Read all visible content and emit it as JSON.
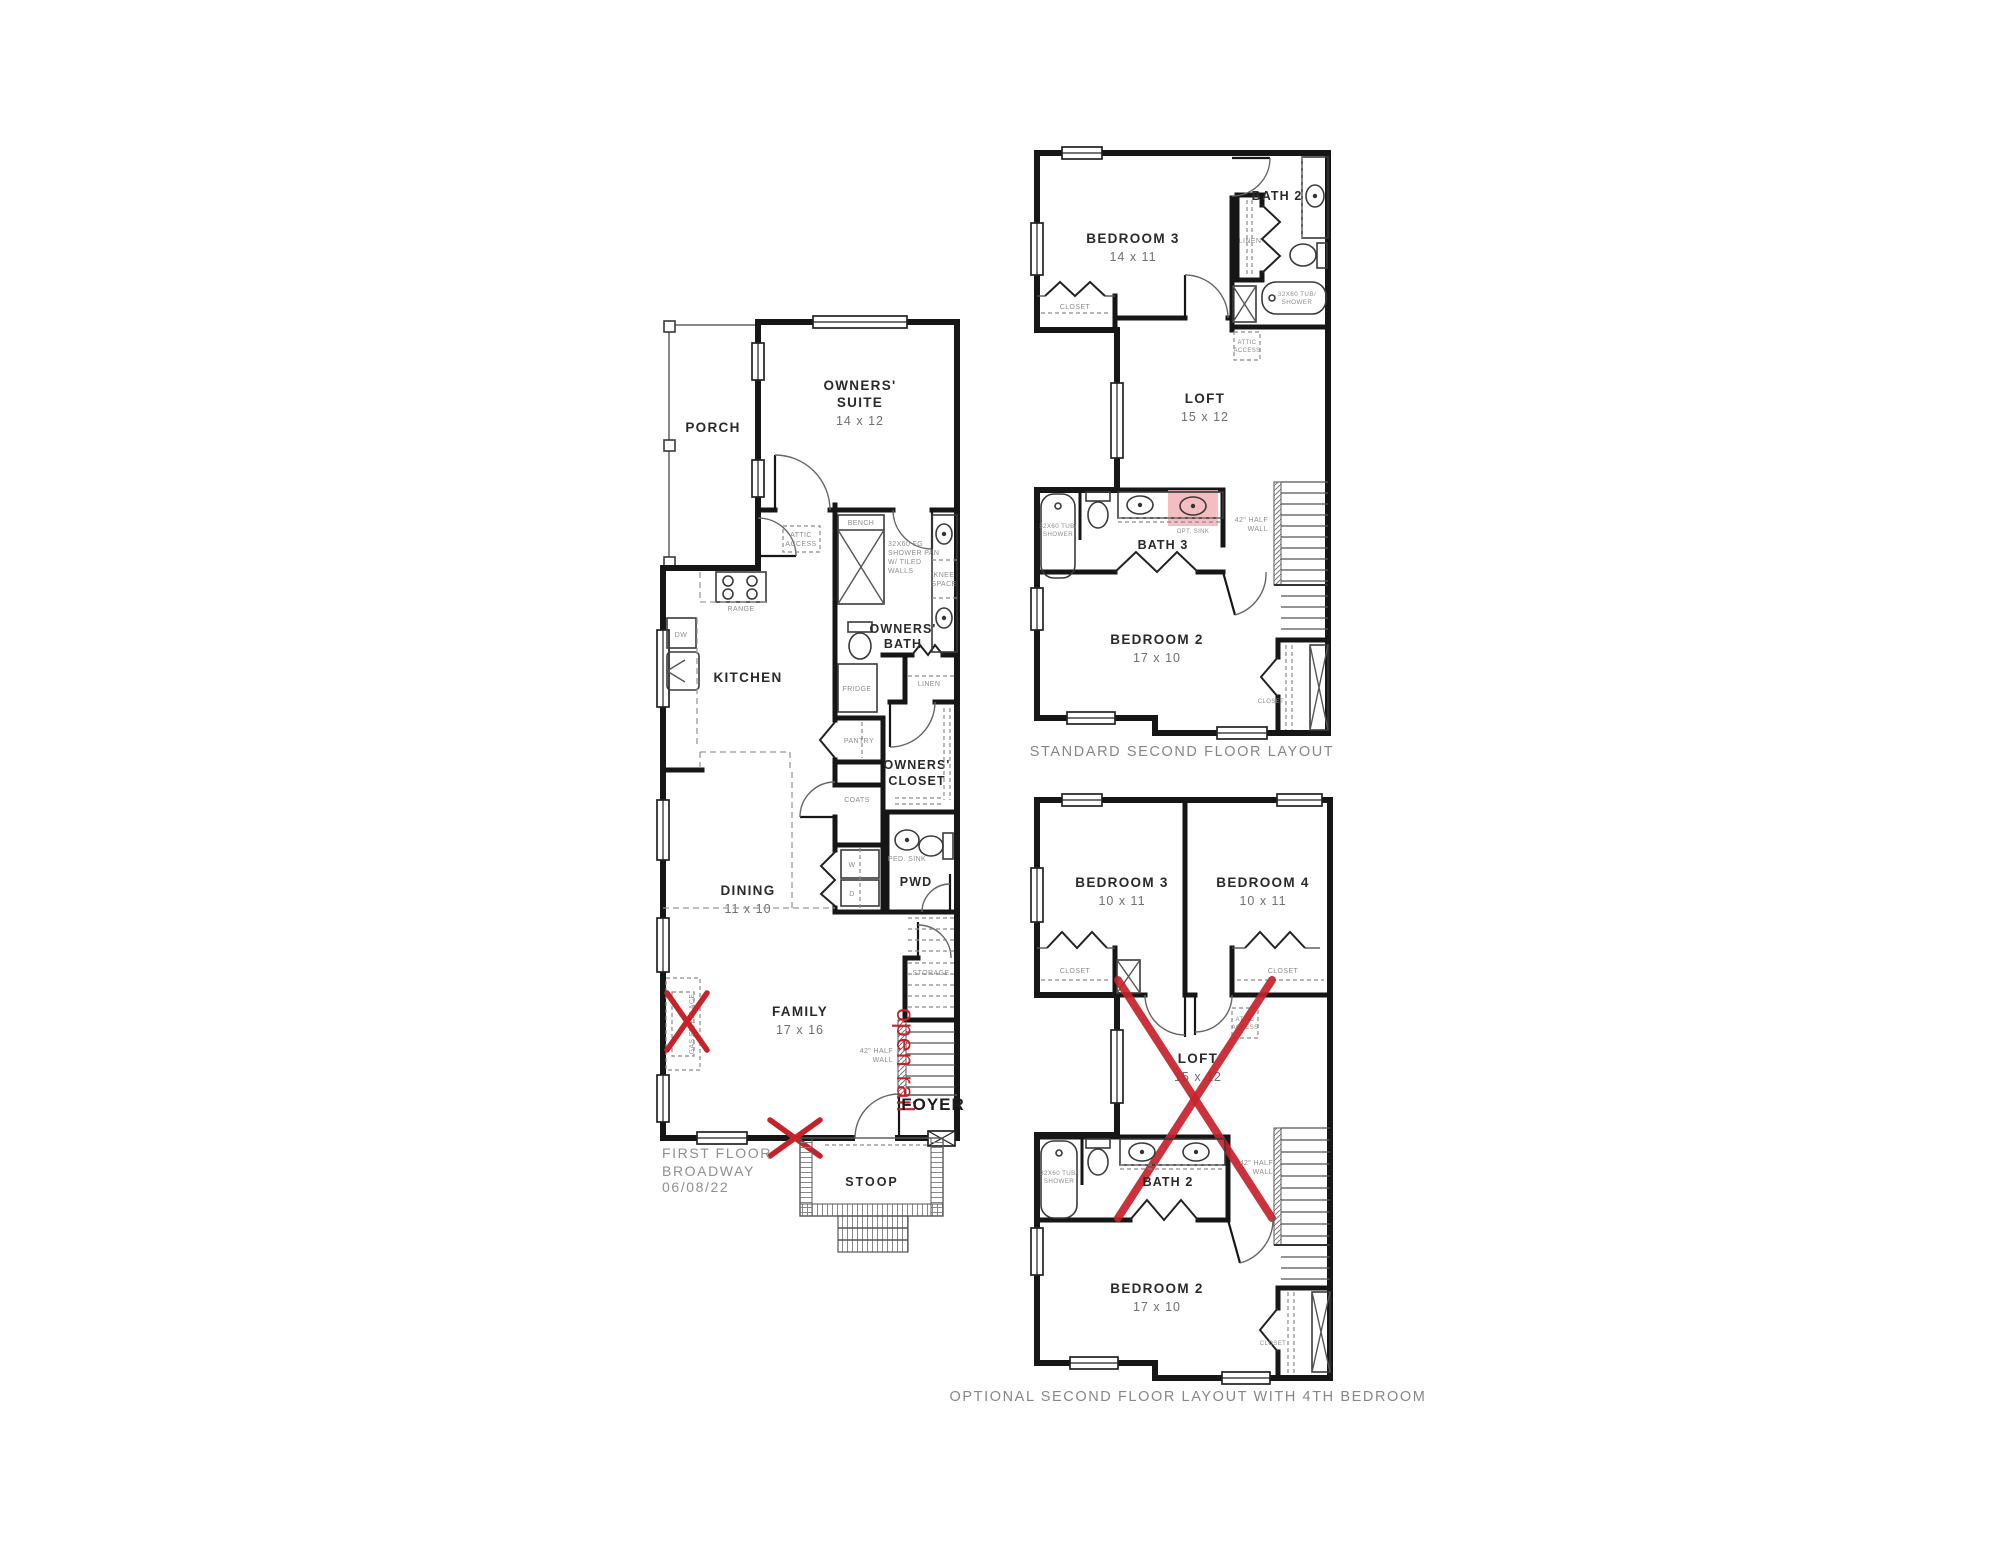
{
  "colors": {
    "redline": "#c5222a",
    "pink_highlight": "#f1b2b6",
    "wall": "#161616"
  },
  "first_floor": {
    "porch": "PORCH",
    "owners_suite": {
      "lines": [
        "OWNERS'",
        "SUITE"
      ],
      "dim": "14 x 12"
    },
    "attic_access": {
      "lines": [
        "ATTIC",
        "ACCESS"
      ]
    },
    "bench": "BENCH",
    "shower_pan": {
      "lines": [
        "32X60 FG",
        "SHOWER PAN",
        "W/ TILED",
        "WALLS"
      ]
    },
    "knee_space": {
      "lines": [
        "KNEE",
        "SPACE"
      ]
    },
    "owners_bath": {
      "lines": [
        "OWNERS'",
        "BATH"
      ]
    },
    "linen": "LINEN",
    "range": "RANGE",
    "dw": "DW",
    "kitchen": "KITCHEN",
    "fridge": "FRIDGE",
    "pantry": "PANTRY",
    "owners_closet": {
      "lines": [
        "OWNERS'",
        "CLOSET"
      ]
    },
    "coats": "COATS",
    "dining": {
      "name": "DINING",
      "dim": "11 x 10"
    },
    "washer": "W",
    "dryer": "D",
    "ped_sink": "PED. SINK",
    "pwd": "PWD",
    "storage": "STORAGE",
    "half_wall": {
      "lines": [
        "42\" HALF",
        "WALL"
      ]
    },
    "gas_fireplace": "GAS FIREPLACE",
    "family": {
      "name": "FAMILY",
      "dim": "17 x 16"
    },
    "foyer": "FOYER",
    "stoop": "STOOP",
    "title_lines": [
      "FIRST FLOOR",
      "BROADWAY",
      "06/08/22"
    ]
  },
  "standard_second": {
    "bedroom3": {
      "name": "BEDROOM 3",
      "dim": "14 x 11"
    },
    "bath2": "BATH 2",
    "linen": "LINEN",
    "tub": {
      "lines": [
        "32X60 TUB/",
        "SHOWER"
      ]
    },
    "closet_b3": "CLOSET",
    "attic_access": {
      "lines": [
        "ATTIC",
        "ACCESS"
      ]
    },
    "loft": {
      "name": "LOFT",
      "dim": "15 x 12"
    },
    "tub3": {
      "lines": [
        "32X60 TUB/",
        "SHOWER"
      ]
    },
    "bath3": "BATH 3",
    "opt_sink": "OPT. SINK",
    "half_wall": {
      "lines": [
        "42\" HALF",
        "WALL"
      ]
    },
    "bedroom2": {
      "name": "BEDROOM 2",
      "dim": "17 x 10"
    },
    "closet_b2": "CLOSET",
    "caption": "STANDARD SECOND FLOOR LAYOUT"
  },
  "optional_second": {
    "bedroom3": {
      "name": "BEDROOM 3",
      "dim": "10 x 11"
    },
    "bedroom4": {
      "name": "BEDROOM 4",
      "dim": "10 x 11"
    },
    "closet_b3": "CLOSET",
    "closet_b4": "CLOSET",
    "attic_access": {
      "lines": [
        "ATTIC",
        "ACCESS"
      ]
    },
    "loft": {
      "name": "LOFT",
      "dim": "15 x 12"
    },
    "tub": {
      "lines": [
        "32X60 TUB/",
        "SHOWER"
      ]
    },
    "bath2": "BATH 2",
    "half_wall": {
      "lines": [
        "42\" HALF",
        "WALL"
      ]
    },
    "bedroom2": {
      "name": "BEDROOM 2",
      "dim": "17 x 10"
    },
    "closet_b2": "CLOSET",
    "caption": "OPTIONAL SECOND FLOOR LAYOUT WITH 4TH BEDROOM"
  },
  "annotations": {
    "open_rail": "open rail"
  }
}
